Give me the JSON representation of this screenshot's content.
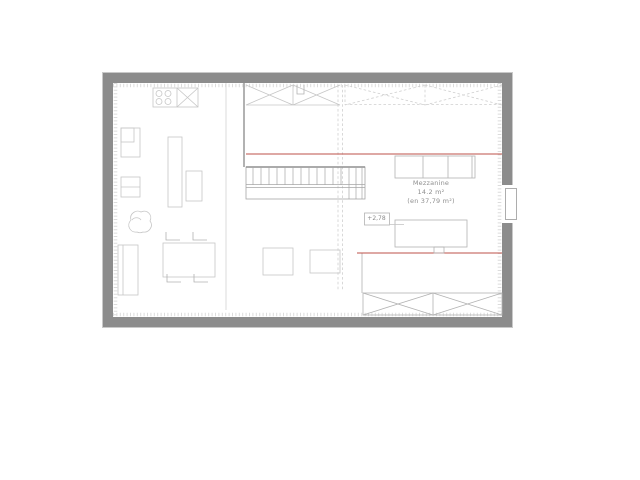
{
  "plan": {
    "mezzanine": {
      "name": "Mezzanine",
      "area": "14.2 m²",
      "floor_area": "(en 37,79 m²)"
    },
    "elevation": "+2,78",
    "colors": {
      "wall": "#8c8c8c",
      "wall_outline": "#c9c9c9",
      "furniture_line": "#c6c6c6",
      "stair_line": "#a6a6a6",
      "height_limit_red": "#bd5149",
      "insulation_hatch": "#dcdcdc",
      "label_text": "#8f8f8f"
    }
  }
}
